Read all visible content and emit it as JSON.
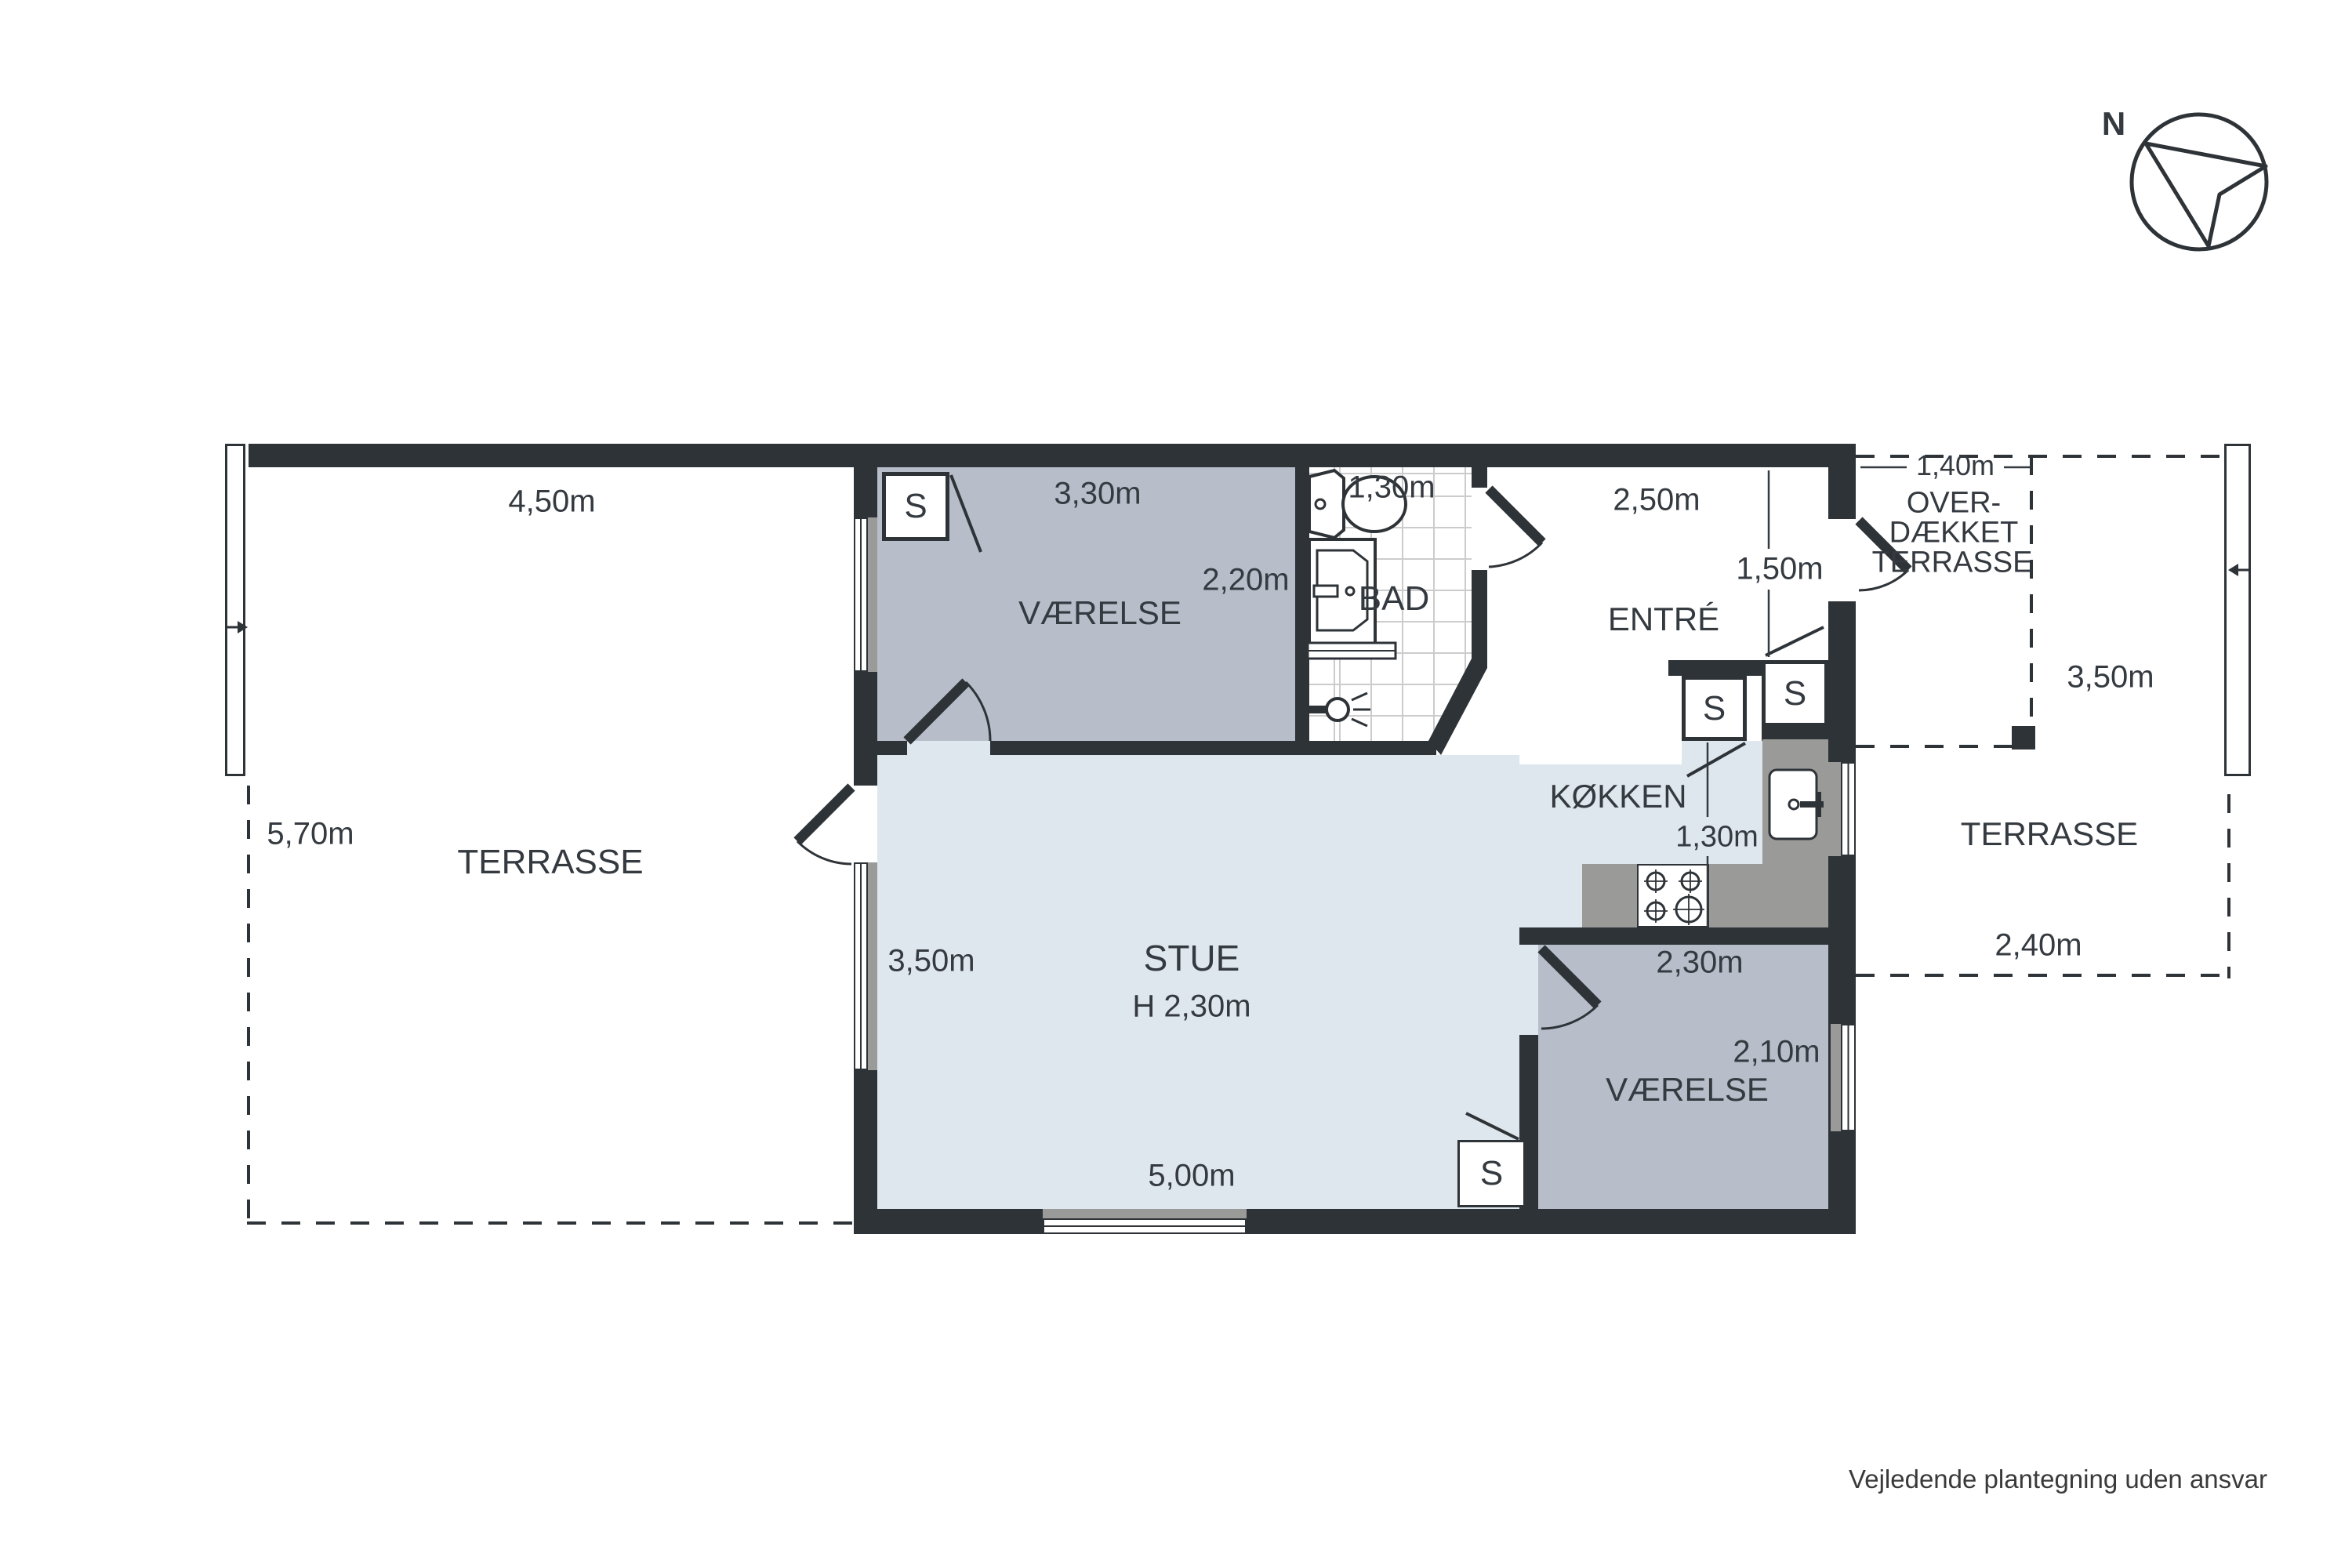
{
  "meta": {
    "type": "floor-plan",
    "language": "da"
  },
  "colors": {
    "wall": "#2e3338",
    "floor_light": "#dfe7ee",
    "floor_gray": "#b7bdc9",
    "counter_gray": "#9a9a98",
    "tile_line": "#cccccc",
    "text": "#343a40"
  },
  "compass": {
    "label": "N"
  },
  "closet": {
    "label": "S"
  },
  "areas": {
    "terrasse_left": {
      "name": "TERRASSE",
      "width": "4,50m",
      "height": "5,70m"
    },
    "vaerelse_1": {
      "name": "VÆRELSE",
      "width": "3,30m",
      "height": "2,20m"
    },
    "bad": {
      "name": "BAD",
      "width": "1,30m"
    },
    "entre": {
      "name": "ENTRÉ",
      "width": "2,50m",
      "height": "1,50m"
    },
    "koekken": {
      "name": "KØKKEN",
      "width": "1,30m"
    },
    "stue": {
      "name": "STUE",
      "ceiling_height": "H 2,30m",
      "side": "3,50m",
      "width": "5,00m"
    },
    "vaerelse_2": {
      "name": "VÆRELSE",
      "width": "2,30m",
      "height": "2,10m"
    },
    "overdaekket_terrasse": {
      "name_line1": "OVER-",
      "name_line2": "DÆKKET",
      "name_line3": "TERRASSE",
      "width": "1,40m",
      "height": "3,50m"
    },
    "terrasse_right": {
      "name": "TERRASSE",
      "width": "2,40m"
    }
  },
  "footer": {
    "disclaimer": "Vejledende plantegning uden ansvar"
  }
}
